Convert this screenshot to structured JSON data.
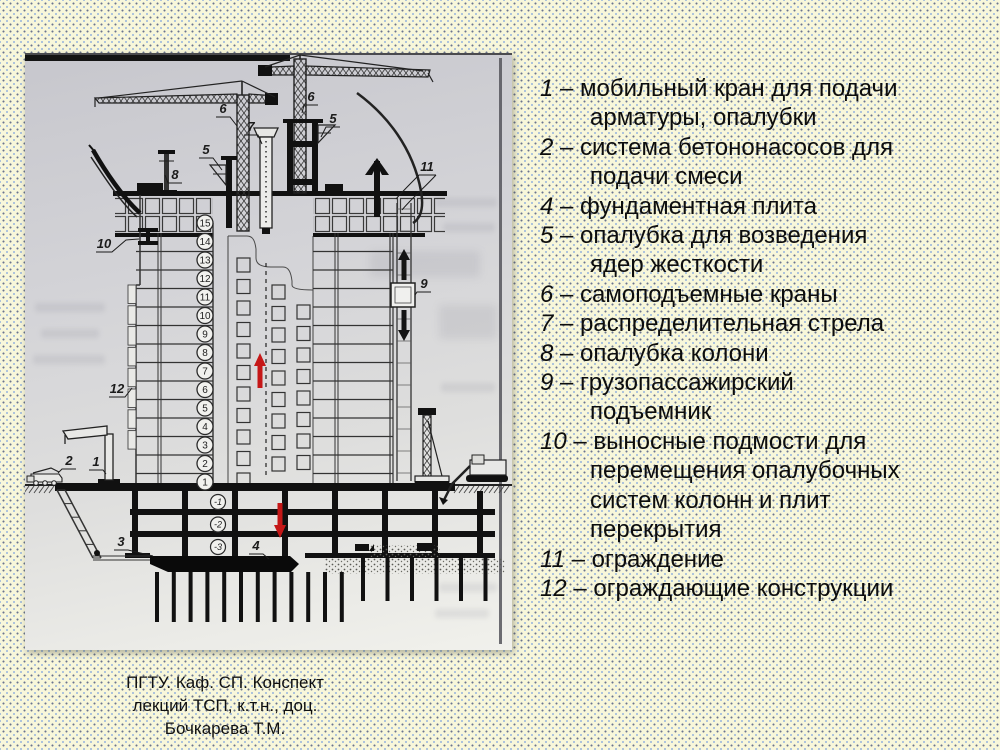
{
  "slide": {
    "background_color": "#f8f7da",
    "dot_dark": "#6b7590",
    "dot_light": "#9fb9dc",
    "red_arrow_color": "#c51717",
    "black_arrow_color": "#141414"
  },
  "diagram": {
    "labels": {
      "l1": "1",
      "l2": "2",
      "l3": "3",
      "l4": "4",
      "l5a": "5",
      "l5b": "5",
      "l6a": "6",
      "l6b": "6",
      "l7": "7",
      "l8": "8",
      "l9": "9",
      "l10": "10",
      "l11": "11",
      "l12": "12"
    },
    "floors_above": [
      "15",
      "14",
      "13",
      "12",
      "11",
      "10",
      "9",
      "8",
      "7",
      "6",
      "5",
      "4",
      "3",
      "2",
      "1"
    ],
    "floors_below": [
      "-1",
      "-2",
      "-3"
    ]
  },
  "legend": {
    "items": [
      {
        "num": "1",
        "lines": [
          "мобильный кран для подачи",
          "арматуры, опалубки"
        ]
      },
      {
        "num": "2",
        "lines": [
          "система бетононасосов для",
          "подачи смеси"
        ]
      },
      {
        "num": "4",
        "lines": [
          "фундаментная плита"
        ]
      },
      {
        "num": "5",
        "lines": [
          "опалубка для возведения",
          "ядер жесткости"
        ]
      },
      {
        "num": "6",
        "lines": [
          "самоподъемные краны"
        ]
      },
      {
        "num": "7",
        "lines": [
          "распределительная стрела"
        ]
      },
      {
        "num": "8",
        "lines": [
          "опалубка колони"
        ]
      },
      {
        "num": "9",
        "lines": [
          "грузопассажирский",
          "подъемник"
        ]
      },
      {
        "num": "10",
        "lines": [
          "выносные подмости для",
          "перемещения опалубочных",
          "систем колонн и плит",
          "перекрытия"
        ]
      },
      {
        "num": "11",
        "lines": [
          "ограждение"
        ]
      },
      {
        "num": "12",
        "lines": [
          "ограждающие конструкции"
        ]
      }
    ]
  },
  "caption": {
    "lines": [
      "ПГТУ. Каф. СП. Конспект",
      "лекций ТСП, к.т.н., доц.",
      "Бочкарева Т.М."
    ]
  }
}
